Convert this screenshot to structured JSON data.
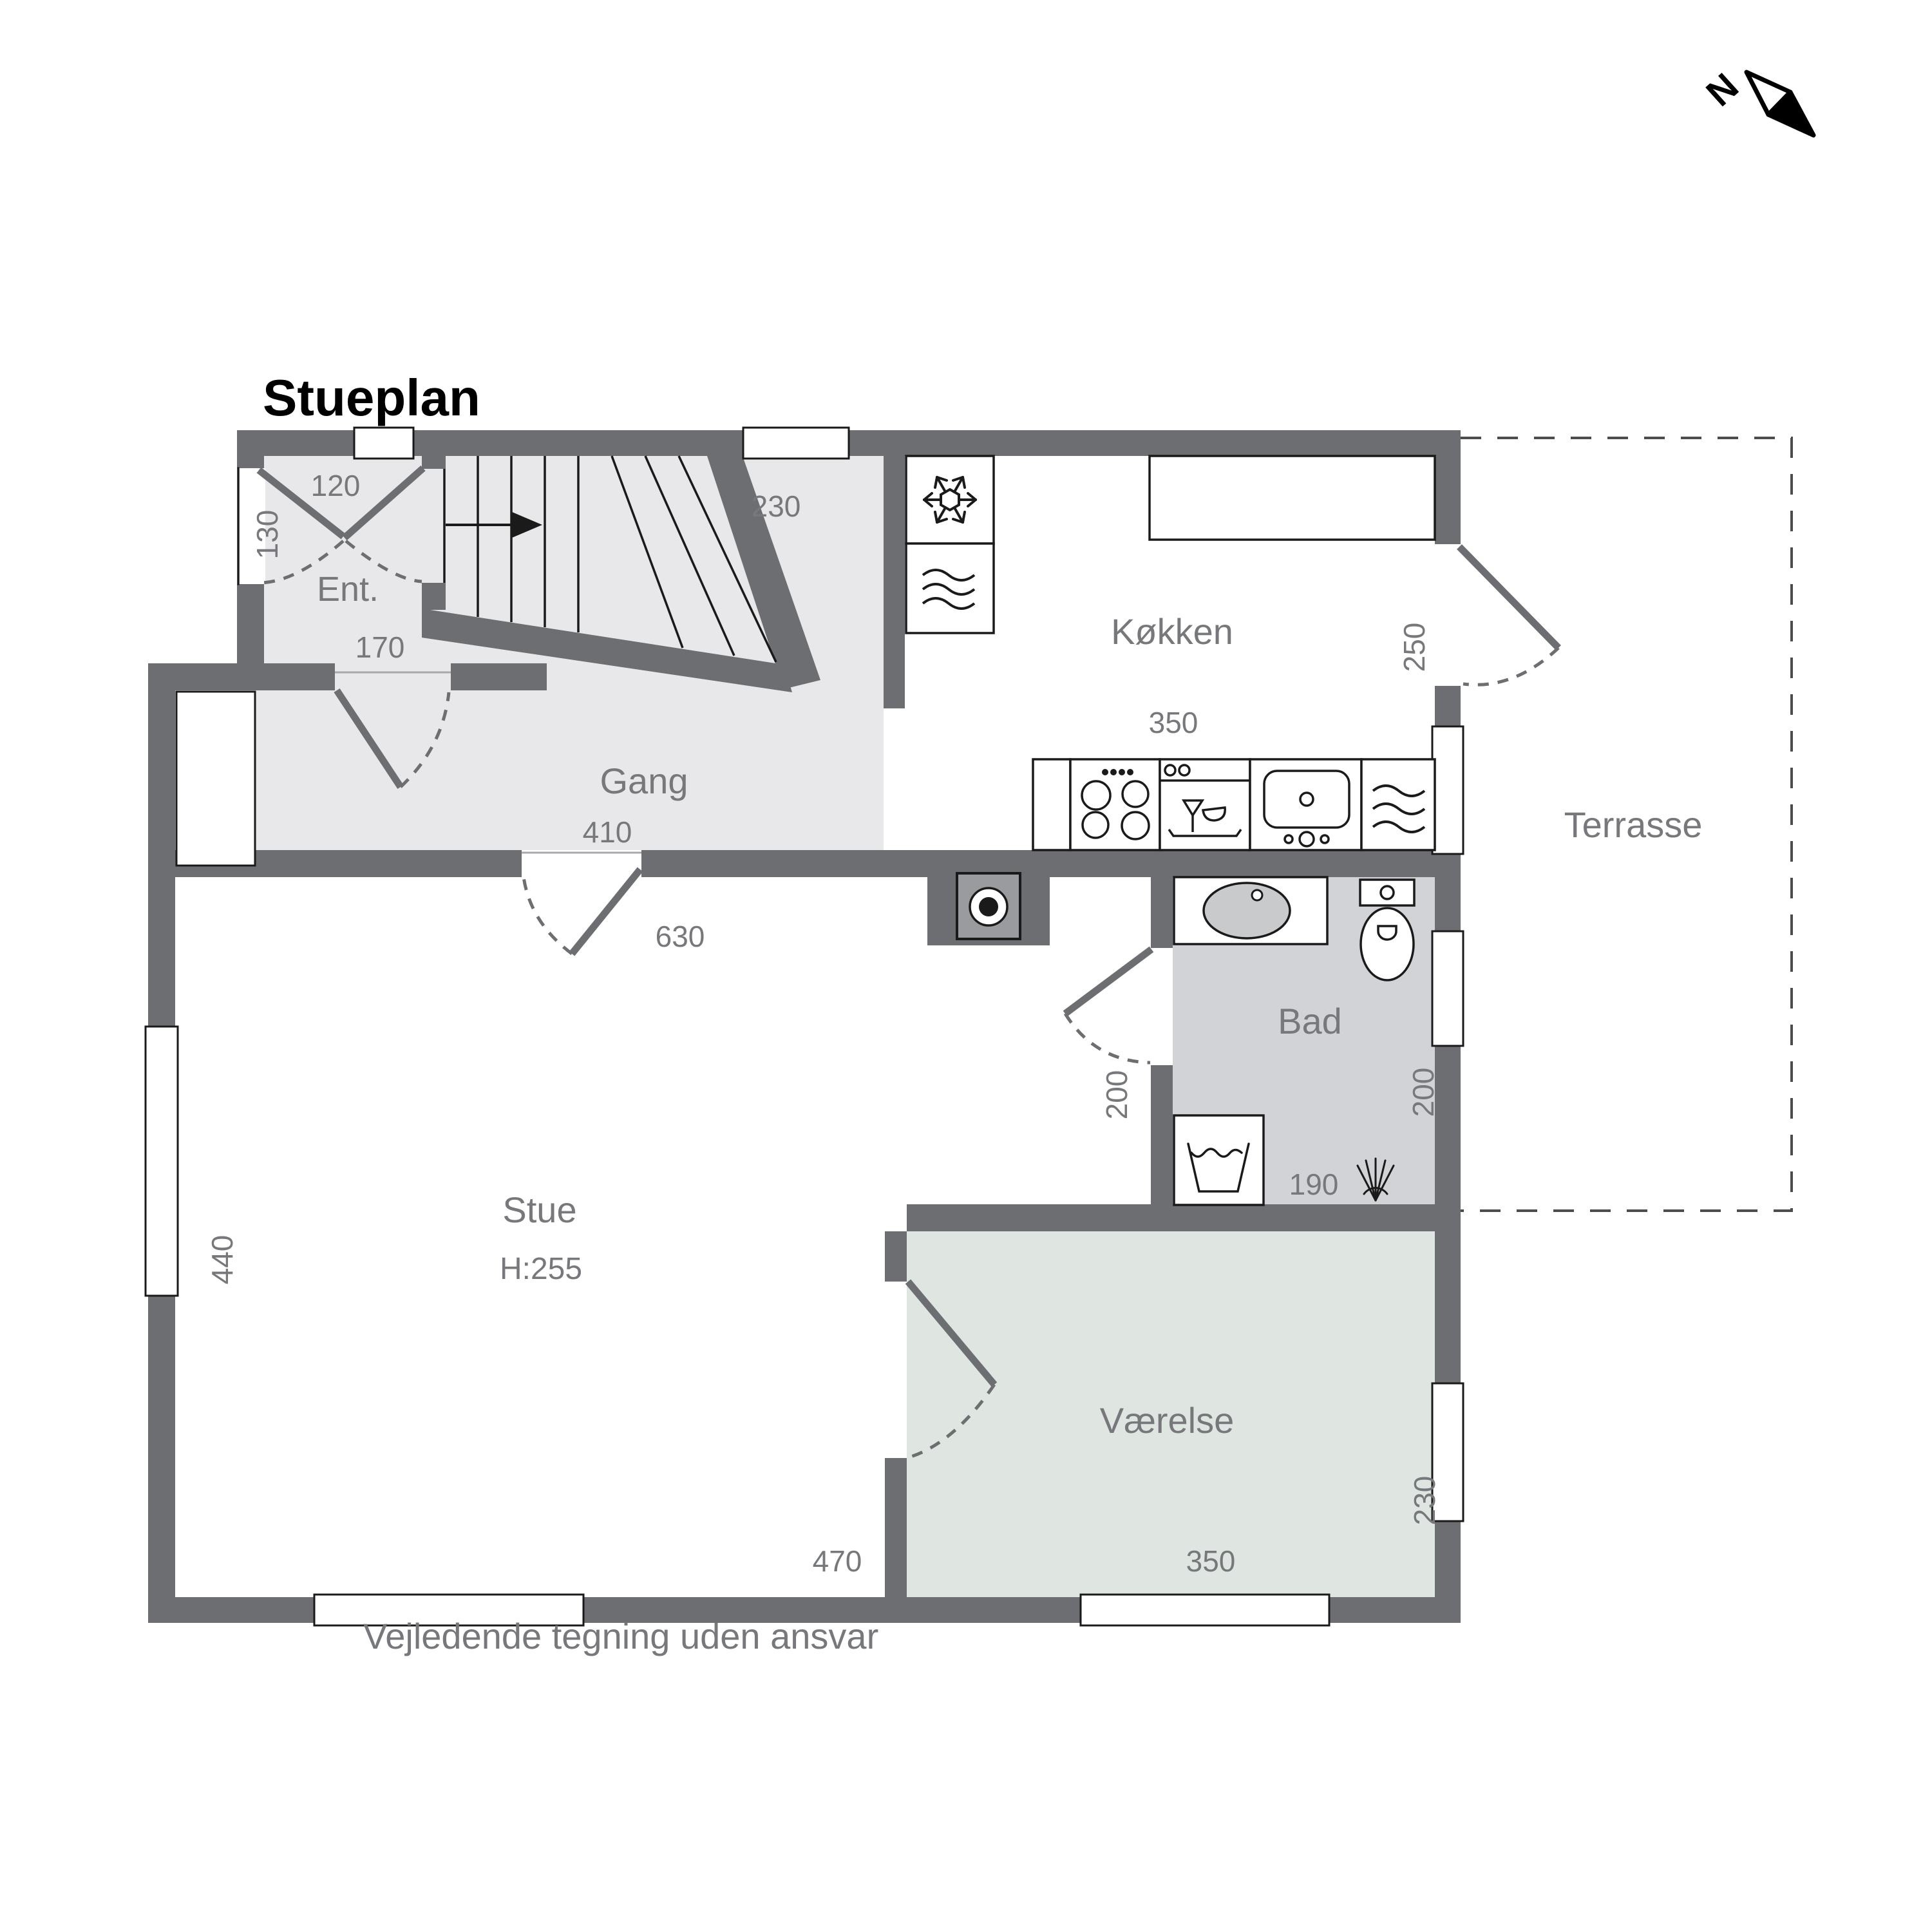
{
  "title": "Stueplan",
  "disclaimer": "Vejledende tegning uden ansvar",
  "north": {
    "label": "N"
  },
  "rooms": {
    "ent": {
      "label": "Ent."
    },
    "gang": {
      "label": "Gang"
    },
    "kitchen": {
      "label": "Køkken"
    },
    "bath": {
      "label": "Bad"
    },
    "living": {
      "label": "Stue",
      "ceiling_height": "H:255"
    },
    "bedroom": {
      "label": "Værelse"
    },
    "terrace": {
      "label": "Terrasse"
    }
  },
  "dims": {
    "ent_door": "120",
    "ent_side_door": "130",
    "ent_closet": "170",
    "hall_top": "230",
    "hall_width": "410",
    "living_opening": "630",
    "kitchen_width": "350",
    "kitchen_terrace_door": "250",
    "bath_door": "200",
    "bath_width": "200",
    "bath_length": "190",
    "living_height": "440",
    "living_width": "470",
    "bedroom_width": "350",
    "bedroom_height": "230"
  },
  "colors": {
    "wall": "#6d6e71",
    "hall_floor": "#e8e8ea",
    "bath_floor": "#d2d3d6",
    "bedroom_floor": "#dfe5e0",
    "label_gray": "#77787b",
    "line_black": "#1a1a1a"
  }
}
